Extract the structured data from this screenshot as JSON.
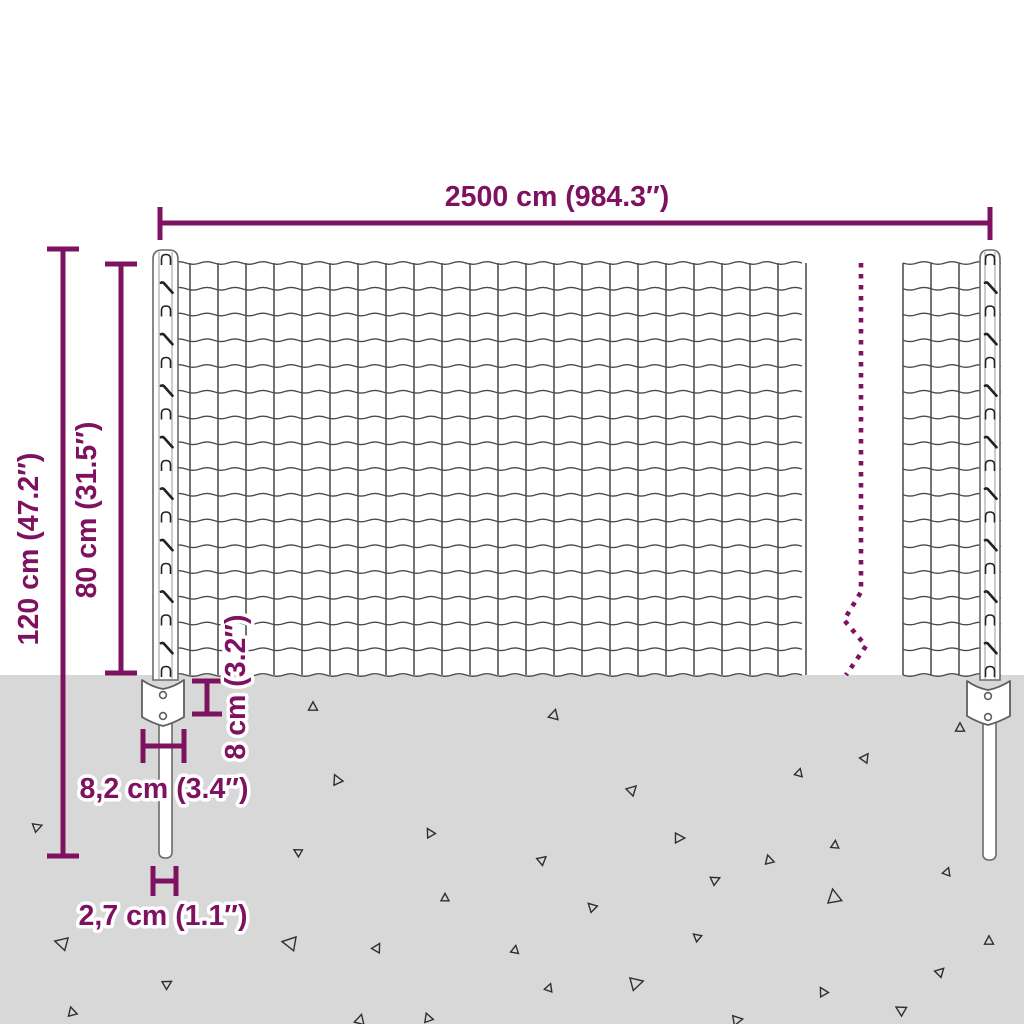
{
  "diagram": {
    "subject": "wire-mesh-fence-with-posts-dimension-diagram",
    "colors": {
      "accent": "#7E1260",
      "wire": "#4A4A4A",
      "ground": "#D8D8D8",
      "post_fill": "#FFFFFF",
      "post_outline": "#6A6A6A"
    },
    "labels": {
      "width": "2500 cm (984.3″)",
      "total_height": "120 cm (47.2″)",
      "mesh_height": "80 cm (31.5″)",
      "anchor_height": "8 cm (3.2″)",
      "anchor_width": "8,2 cm (3.4″)",
      "post_diameter": "2,7 cm (1.1″)"
    },
    "ground": {
      "triangles": [
        [
          313,
          707,
          9,
          0
        ],
        [
          554,
          715,
          10,
          15
        ],
        [
          960,
          728,
          9,
          0
        ],
        [
          337,
          780,
          10,
          -25
        ],
        [
          865,
          758,
          9,
          35
        ],
        [
          799,
          773,
          8,
          15
        ],
        [
          632,
          790,
          10,
          45
        ],
        [
          679,
          838,
          10,
          90
        ],
        [
          37,
          827,
          9,
          70
        ],
        [
          298,
          852,
          8,
          -60
        ],
        [
          430,
          833,
          9,
          -30
        ],
        [
          542,
          860,
          9,
          50
        ],
        [
          769,
          860,
          9,
          -15
        ],
        [
          835,
          845,
          8,
          5
        ],
        [
          947,
          872,
          8,
          20
        ],
        [
          715,
          880,
          9,
          65
        ],
        [
          834,
          897,
          14,
          -10
        ],
        [
          592,
          907,
          9,
          -45
        ],
        [
          445,
          898,
          8,
          0
        ],
        [
          62,
          943,
          13,
          -75
        ],
        [
          290,
          943,
          14,
          -80
        ],
        [
          377,
          948,
          9,
          30
        ],
        [
          697,
          937,
          8,
          -50
        ],
        [
          989,
          941,
          9,
          0
        ],
        [
          167,
          984,
          9,
          60
        ],
        [
          636,
          983,
          13,
          75
        ],
        [
          823,
          992,
          9,
          -30
        ],
        [
          940,
          972,
          9,
          45
        ],
        [
          72,
          1012,
          9,
          -15
        ],
        [
          549,
          988,
          8,
          20
        ],
        [
          901,
          1010,
          10,
          -60
        ],
        [
          737,
          1020,
          10,
          80
        ],
        [
          360,
          1020,
          10,
          15
        ],
        [
          515,
          950,
          8,
          10
        ],
        [
          428,
          1018,
          9,
          -20
        ]
      ]
    }
  }
}
